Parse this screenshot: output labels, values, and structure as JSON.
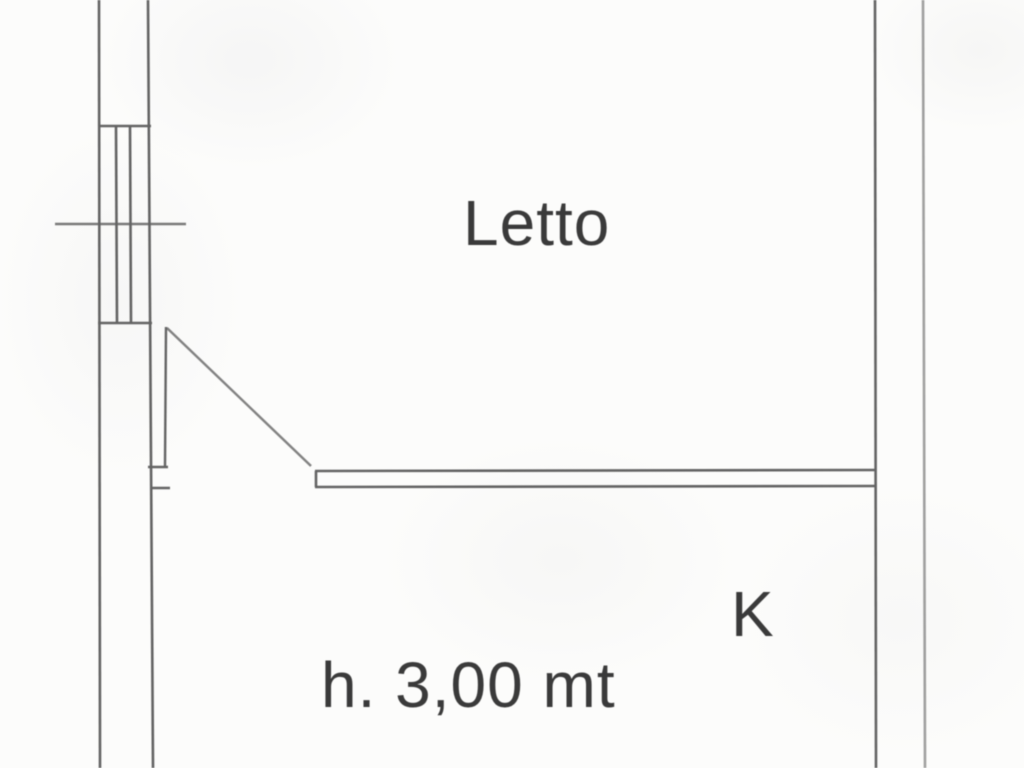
{
  "document": {
    "type": "scanned floor plan (planimetria)",
    "labels": {
      "bedroom": "Letto",
      "kitchen": "K",
      "height_note": "h. 3,00 mt"
    },
    "symbols": {
      "window": "window-symbol",
      "door": "door-swing-symbol"
    },
    "colors": {
      "background": "#fcfcfb",
      "wall_line": "#636363",
      "text": "#3a3a3a"
    }
  }
}
